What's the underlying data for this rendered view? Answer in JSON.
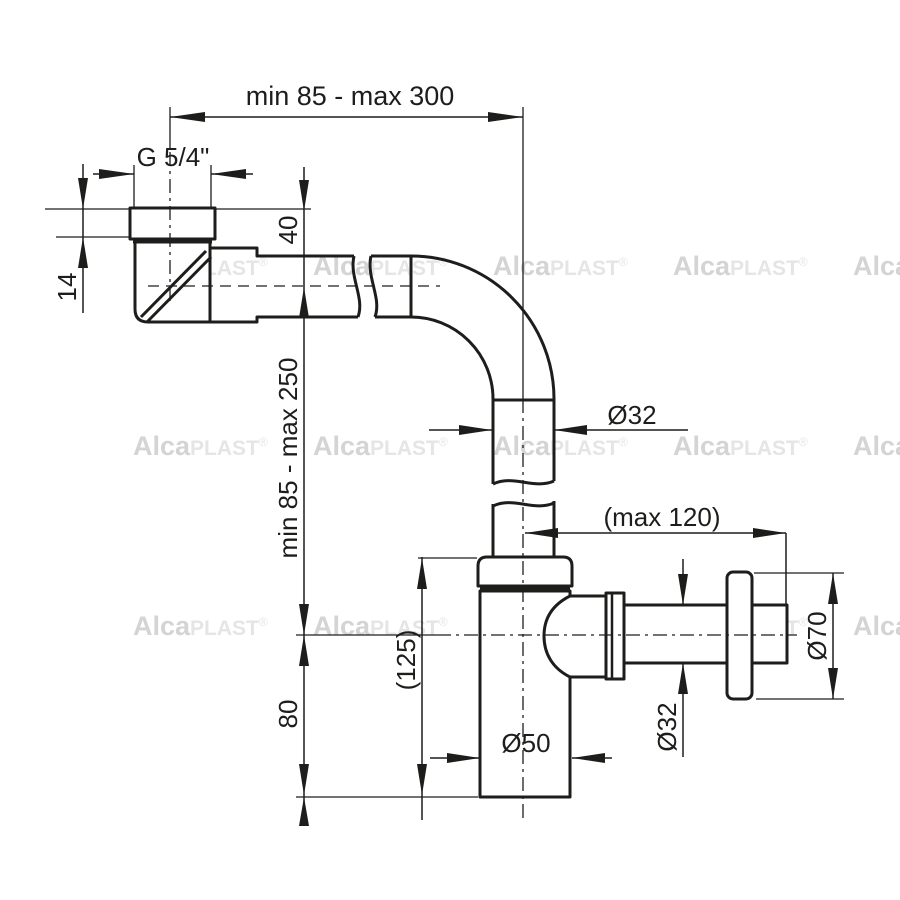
{
  "labels": {
    "top_width": "min 85 - max 300",
    "thread": "G 5/4\"",
    "nut_height": "14",
    "inlet_drop": "40",
    "vertical_range": "min 85 - max 250",
    "pipe_diameter": "Ø32",
    "outlet_reach": "(max 120)",
    "body_height_ref": "(125)",
    "body_bottom": "80",
    "body_diameter": "Ø50",
    "outlet_diameter": "Ø32",
    "flange_diameter": "Ø70"
  },
  "watermark": {
    "brand_bold": "Alca",
    "brand_light": "PLAST",
    "registered": "®"
  },
  "colors": {
    "line": "#1d1d1b",
    "background": "#ffffff",
    "watermark_bold": "#d4d4d4",
    "watermark_light": "#e5e5e5"
  }
}
